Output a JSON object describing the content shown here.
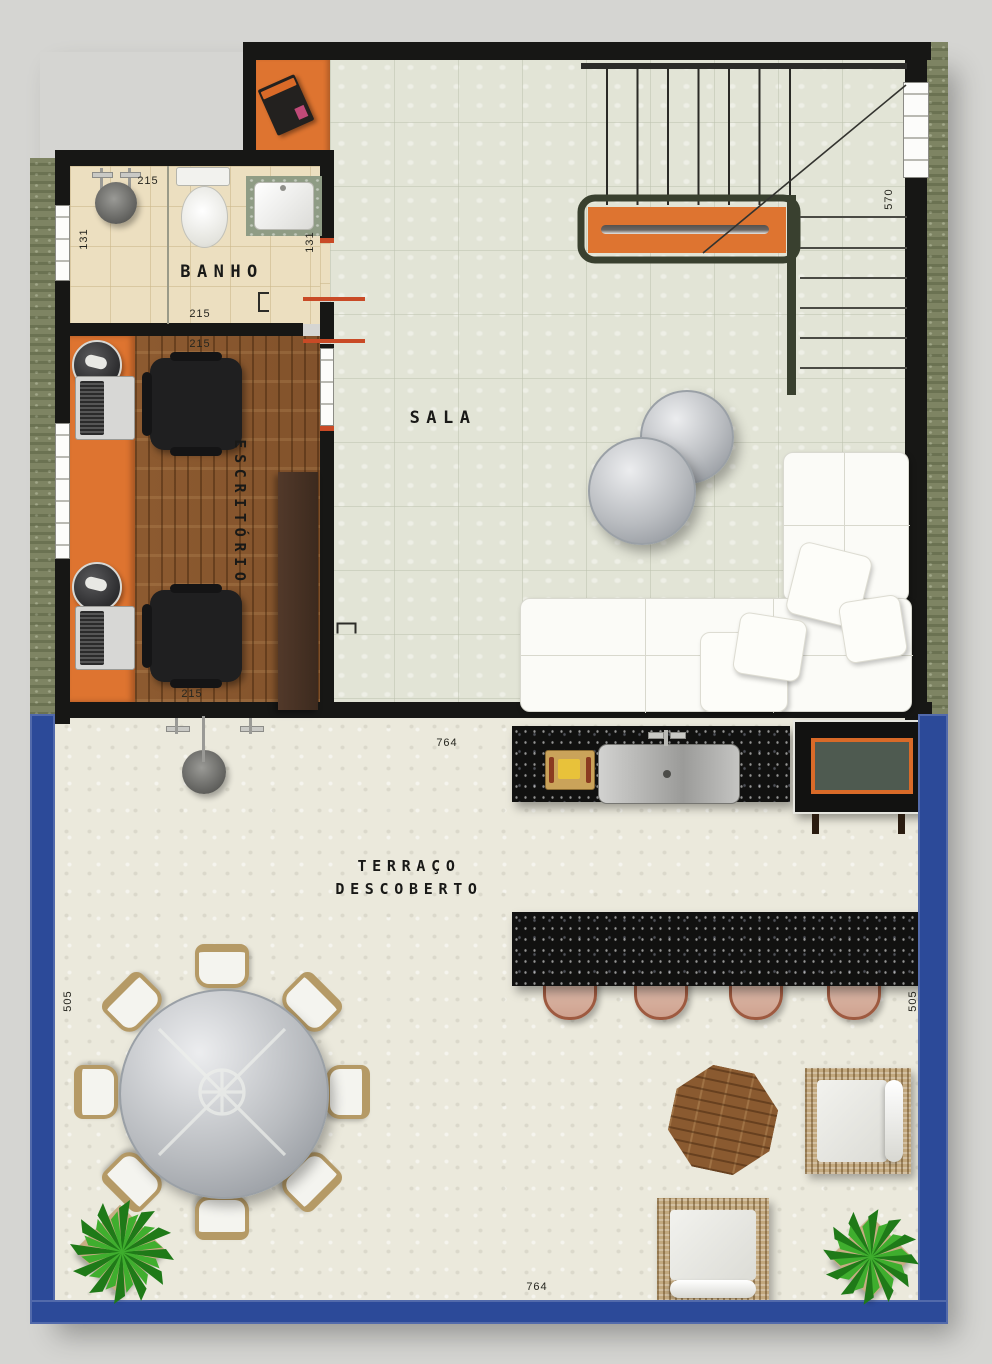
{
  "plan": {
    "type": "residential floor plan, top view",
    "labels": {
      "banho": "BANHO",
      "escritorio": "ESCRITÓRIO",
      "sala": "SALA",
      "terraco_line1": "TERRAÇO",
      "terraco_line2": "DESCOBERTO"
    },
    "dimensions": {
      "banho_top": "215",
      "banho_left": "131",
      "banho_right": "131",
      "banho_bottom": "215",
      "escritorio_top": "215",
      "escritorio_bottom": "215",
      "stairs": "570",
      "terraco_top": "764",
      "terraco_left": "505",
      "terraco_right": "505",
      "terraco_bottom": "764"
    },
    "colors": {
      "wall_black": "#171715",
      "accent_orange": "#de7430",
      "terrace_border_blue": "#2c4a99",
      "wood_floor": "#8a5830",
      "granite_counter": "#111110",
      "sala_tile": "#e2e4d6",
      "banho_floor": "#ecdfc0",
      "terrace_floor": "#ebe9dc",
      "exterior_green": "#7e8463"
    },
    "furniture": [
      "entrance-mat-with-magazine",
      "shower-head",
      "shower-drain",
      "toilet",
      "washbasin",
      "office-desk",
      "laptop x2",
      "office-chair x2",
      "desk-caddy x2",
      "sideboard",
      "l-shaped-staircase",
      "stair-shelf",
      "coffee-table x2",
      "l-shaped-sofa",
      "sofa-pillows",
      "outdoor-kitchen-counter",
      "cutting-board",
      "kitchen-sink",
      "faucet",
      "barbecue-grill",
      "outdoor-shower",
      "bar-counter",
      "bar-stool x4",
      "round-dining-table",
      "dining-chair x8",
      "octagonal-side-table",
      "wicker-armchair x2",
      "potted-plant x2"
    ]
  }
}
